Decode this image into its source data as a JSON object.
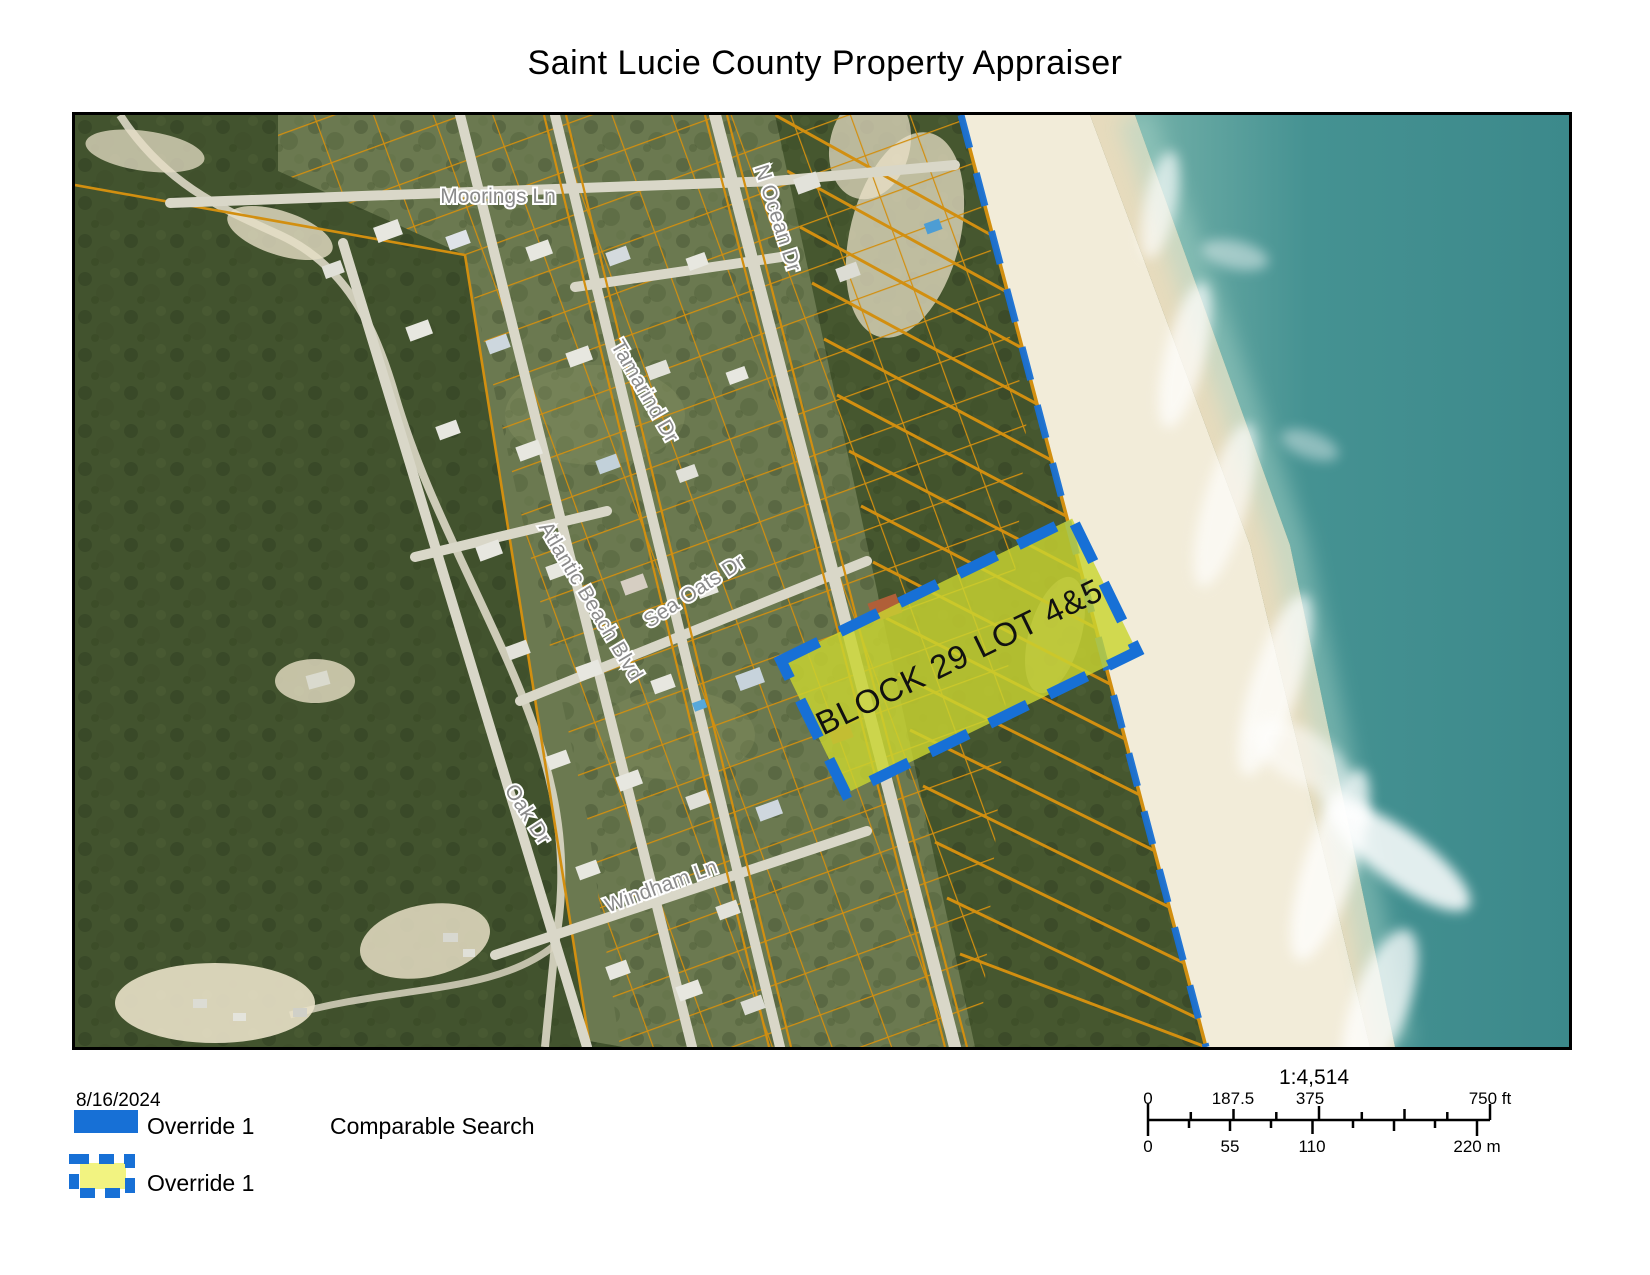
{
  "page": {
    "title": "Saint Lucie County Property Appraiser"
  },
  "map": {
    "highlight_label": "BLOCK 29 LOT 4&5",
    "streets": [
      {
        "name": "Moorings Ln"
      },
      {
        "name": "N Ocean Dr"
      },
      {
        "name": "Tamarind Dr"
      },
      {
        "name": "Atlantic Beach Blvd"
      },
      {
        "name": "Sea Oats Dr"
      },
      {
        "name": "Oak Dr"
      },
      {
        "name": "Windham Ln"
      }
    ]
  },
  "legend": {
    "date": "8/16/2024",
    "override1_label": "Override 1",
    "comparable_search_label": "Comparable Search",
    "override2_label": "Override 1"
  },
  "scalebar": {
    "ratio": "1:4,514",
    "ft": [
      "0",
      "187.5",
      "375",
      "750 ft"
    ],
    "m": [
      "0",
      "55",
      "110",
      "220 m"
    ]
  },
  "colors": {
    "parcel_line_orange": "#d28f10",
    "override_blue": "#1770d6",
    "override_yellow": "#f2f381",
    "highlight_fill": "#c9d431",
    "ocean_teal": "#3c898b",
    "sand": "#f2ecd9"
  }
}
